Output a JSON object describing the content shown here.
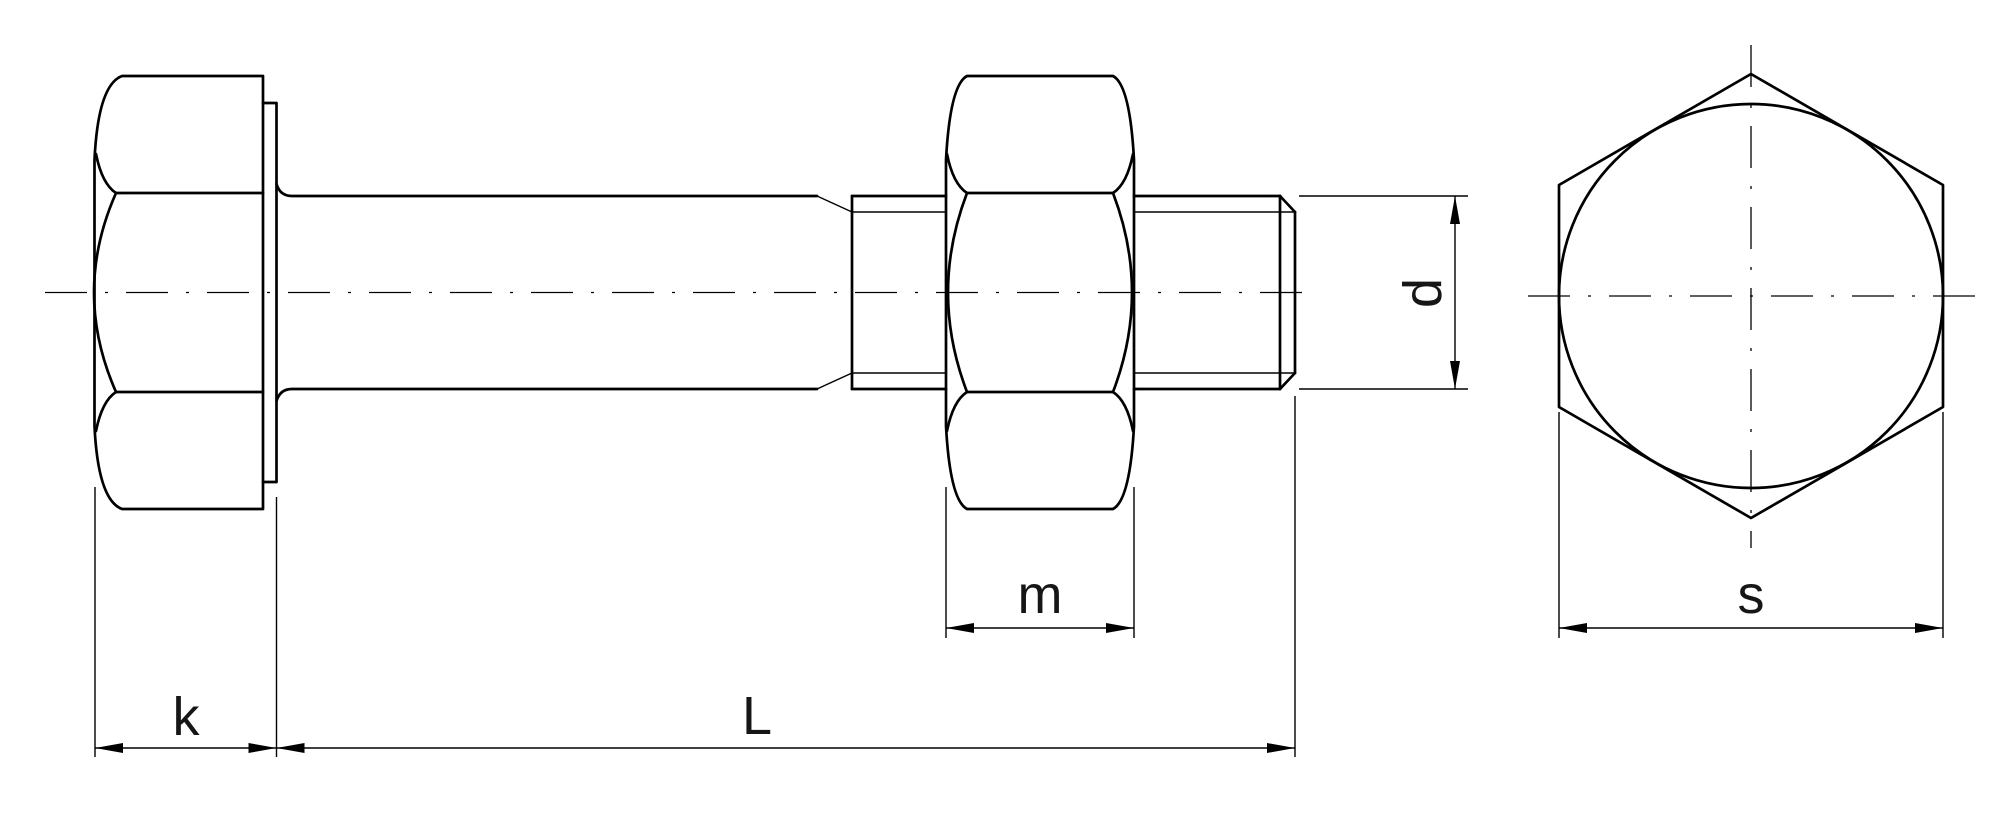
{
  "page": {
    "background_color": "#ffffff"
  },
  "drawing": {
    "colors": {
      "line": "#000000",
      "label": "#161616",
      "background": "#ffffff"
    },
    "labels": {
      "k": "k",
      "L": "L",
      "m": "m",
      "d": "d",
      "s": "s"
    }
  }
}
